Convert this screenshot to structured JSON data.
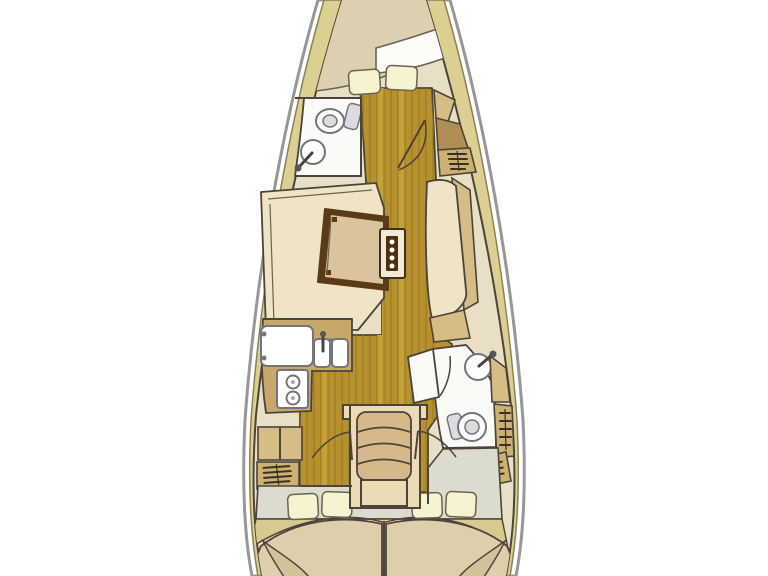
{
  "diagram": {
    "type": "sailboat-interior-floor-plan",
    "orientation": "bow-up",
    "areas": [
      {
        "id": "forward-cabin",
        "icon": "double-berth-icon",
        "features": [
          "mattress",
          "folded-blanket",
          "pillow",
          "pillow"
        ]
      },
      {
        "id": "forward-head",
        "icon": "bathroom-icon",
        "features": [
          "toilet",
          "sink-round"
        ]
      },
      {
        "id": "starboard-forward-lockers",
        "icon": "locker-icon",
        "features": [
          "shelf",
          "wardrobe",
          "vented-hatch"
        ]
      },
      {
        "id": "salon",
        "icon": "settee-icon",
        "features": [
          "port-l-settee",
          "trapezoid-table",
          "mast-post-panel",
          "starboard-settee"
        ]
      },
      {
        "id": "galley",
        "icon": "galley-icon",
        "features": [
          "fridge",
          "double-sink",
          "faucet",
          "two-burner-stove"
        ]
      },
      {
        "id": "aft-head",
        "icon": "bathroom-icon",
        "features": [
          "sink-round",
          "toilet",
          "open-door"
        ]
      },
      {
        "id": "companionway",
        "icon": "steps-icon",
        "features": [
          "four-step-ladder",
          "landing"
        ]
      },
      {
        "id": "port-aft-cabin",
        "icon": "double-berth-icon",
        "features": [
          "mattress",
          "pillow",
          "pillow",
          "vented-locker"
        ]
      },
      {
        "id": "starboard-aft-cabin",
        "icon": "double-berth-icon",
        "features": [
          "mattress",
          "pillow",
          "pillow",
          "vented-locker",
          "vented-locker"
        ]
      }
    ]
  },
  "colors": {
    "background": "#ffffff",
    "hull_line": "#97979a",
    "hull_fill": "#ffffff",
    "deck": "#dbd092",
    "deck_line": "#8d8153",
    "interior": "#e9dfc6",
    "line": "#4c443a",
    "wood": "#b6912d",
    "wood_line": "#96751f",
    "wood_light": "#c5a238",
    "cushion": "#efe5c6",
    "mattress": "#dcd0b0",
    "blanket": "#fbfbf7",
    "pillow": "#f5f3d0",
    "soft_line": "#6b6353",
    "head_floor": "#fafaf6",
    "fixture": "#ffffff",
    "fixture_line": "#74747a",
    "fixture_shade": "#dcdce0",
    "counter": "#c8a76a",
    "cab": "#cdb173",
    "cab_light": "#d6bd85",
    "wardrobe": "#af8d55",
    "grate": "#3a3122",
    "table_border": "#5b3a17",
    "table_top": "#d9c49e",
    "mast_face": "#f3ead4",
    "mast_inner": "#4e3010",
    "steps_frame": "#ecdcb5",
    "steps_tread": "#d5b98c",
    "aft_floor": "#dbdbcf",
    "stern_band": "#d6ca8e",
    "berth": "#ddcfab",
    "berth_fold": "#d2c297"
  }
}
